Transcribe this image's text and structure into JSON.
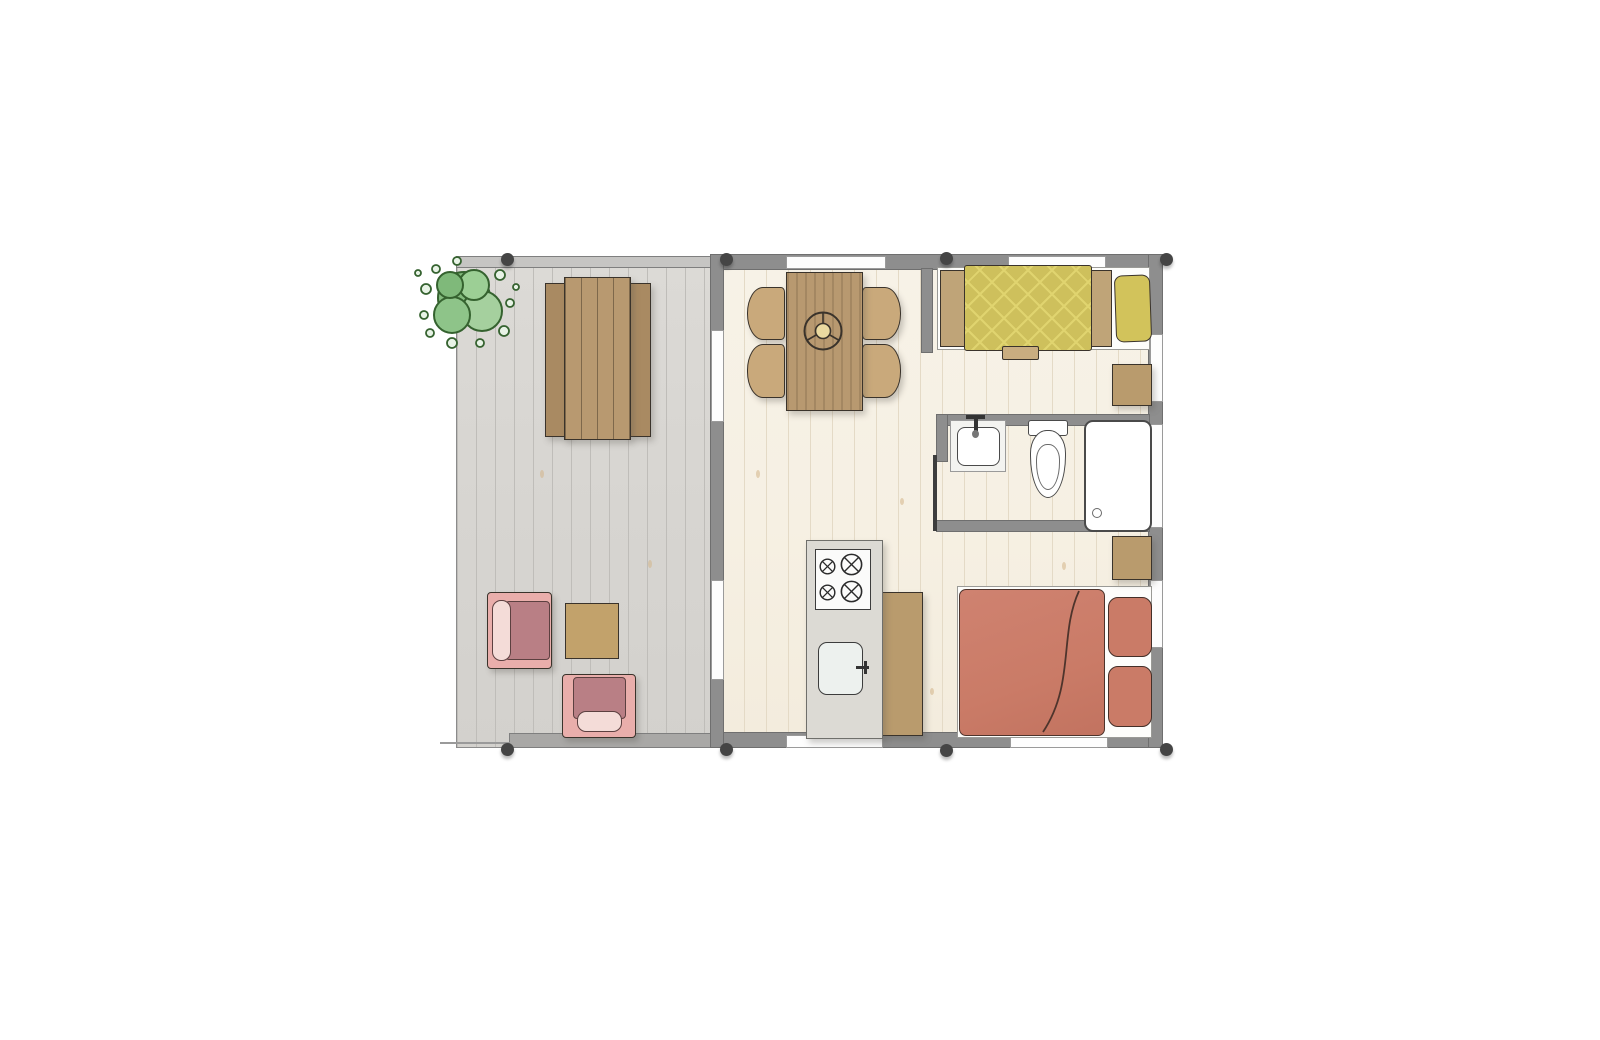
{
  "page": {
    "background": "#ffffff",
    "description": "top-down architectural floor plan of a small cabin with side deck"
  },
  "floor_plan": {
    "colors": {
      "wall": "#8e8e8e",
      "wall-edge": "#6f6f6f",
      "window-white": "#fdfdfd",
      "rail": "#c6c5c3",
      "deck-band": "#a9a8a6",
      "deck-floor": "#d8d6d2",
      "deck-line": "#bfbdb9",
      "floor": "#f6f0e3",
      "floor-line": "#e4dac6",
      "knot": "#d3b488",
      "outline": "#3a332b",
      "wood-tan": "#b89970",
      "wood-chair": "#c9a97b",
      "wood-bench": "#a98a62",
      "wood-side": "#c2a26b",
      "nightstand": "#b99b6d",
      "counter": "#b99b6d",
      "headboard": "#bfa478",
      "yellow": "#cec05c",
      "yellow-line": "#e0d46f",
      "pillow-yellow": "#d2c35b",
      "terracotta": "#ca7b67",
      "terracotta-dark": "#4e342c",
      "pink": "#e9aeab",
      "rose": "#b97f85",
      "blush": "#f4dcd8",
      "green": "#84bb7e",
      "green-light": "#a5d09e",
      "green-dark": "#35622f",
      "kitchen": "#dcdad4",
      "stove-white": "#fbfbfa",
      "sink": "#edf1ee",
      "fixture": "#ffffff",
      "fixture-line": "#4a4a4a",
      "mattress": "#fdfdfb",
      "post": "#454545"
    },
    "areas": [
      {
        "name": "deck",
        "floor": "grey wood planks"
      },
      {
        "name": "living-dining-area",
        "floor": "whitewashed wood planks"
      },
      {
        "name": "sleeping-area",
        "floor": "whitewashed wood planks"
      },
      {
        "name": "bathroom",
        "fixtures": [
          "sink",
          "toilet",
          "shower"
        ]
      }
    ],
    "furniture": [
      {
        "name": "bush",
        "area": "deck"
      },
      {
        "name": "picnic-table",
        "area": "deck"
      },
      {
        "name": "armchair-1",
        "area": "deck"
      },
      {
        "name": "armchair-2",
        "area": "deck"
      },
      {
        "name": "side-table",
        "area": "deck"
      },
      {
        "name": "dining-table-with-4-chairs",
        "area": "living-dining-area"
      },
      {
        "name": "table-centerpiece",
        "area": "living-dining-area"
      },
      {
        "name": "kitchen-block-with-stove-and-sink",
        "area": "living-dining-area"
      },
      {
        "name": "kitchen-counter",
        "area": "living-dining-area"
      },
      {
        "name": "single-bed-yellow",
        "area": "sleeping-area"
      },
      {
        "name": "double-bed-terracotta",
        "area": "sleeping-area"
      },
      {
        "name": "nightstand-upper",
        "area": "sleeping-area"
      },
      {
        "name": "nightstand-lower",
        "area": "sleeping-area"
      }
    ],
    "openings": {
      "top_windows": 2,
      "right_windows": 3,
      "bottom_windows": 2,
      "deck_sliding_doors": 2,
      "bathroom_door": 1
    },
    "structure": {
      "corner_posts": 8
    }
  }
}
